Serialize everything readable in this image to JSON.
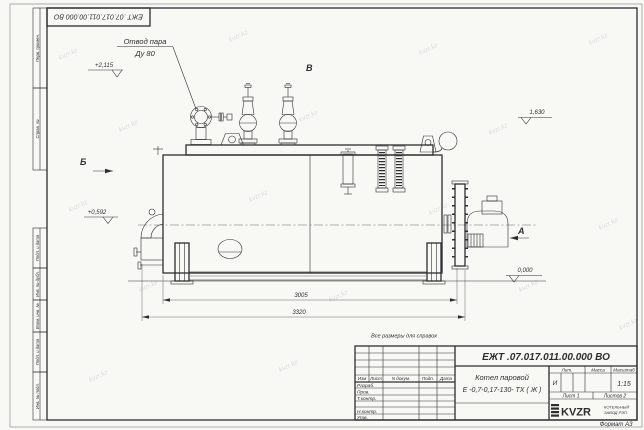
{
  "colors": {
    "paper": "#f8f8f5",
    "ink": "#2e2e31",
    "watermark": "#c3c6ce"
  },
  "watermark": {
    "text": "kvzr.kz"
  },
  "frame": {
    "top_designation": "ЕЖТ .07.017.011.00.000 ВО",
    "format_label": "Формат А3",
    "margin_labels": [
      "Перв. примен.",
      "Справ. №",
      "Подп. и дата",
      "Инв. № дубл.",
      "Взам. инв. №",
      "Подп. и дата",
      "Инв. № подл."
    ]
  },
  "drawing": {
    "note": "Все размеры для справок",
    "callout_steam": {
      "line1": "Отвод пара",
      "line2": "Ду 80"
    },
    "views": {
      "a": "А",
      "b": "Б",
      "v": "В"
    },
    "elevations": {
      "top": "+2,115",
      "left": "+0,592",
      "right": "1,630",
      "zero": "0,000"
    },
    "dimensions": {
      "inner": "3005",
      "overall": "3320"
    }
  },
  "title_block": {
    "designation": "ЕЖТ .07.017.011.00.000 ВО",
    "name_line1": "Котел паровой",
    "name_line2": "Е -0,7-0,17-130- ТХ ( Ж )",
    "rev_headers": [
      "Изм",
      "Лист",
      "N докум.",
      "Подп.",
      "Дата"
    ],
    "sign_rows": [
      "Разраб.",
      "Пров.",
      "Т.контр.",
      "Н.контр.",
      "Утв."
    ],
    "lit_header": "Лит.",
    "mass_header": "Масса",
    "scale_header": "Масштаб",
    "lit_value": "И",
    "scale_value": "1:15",
    "sheet": "Лист 1",
    "sheets": "Листов 2",
    "logo_text": "KVZR",
    "company_line1": "КОТЕЛЬНЫЙ",
    "company_line2": "ЗАВОД РЭП"
  }
}
